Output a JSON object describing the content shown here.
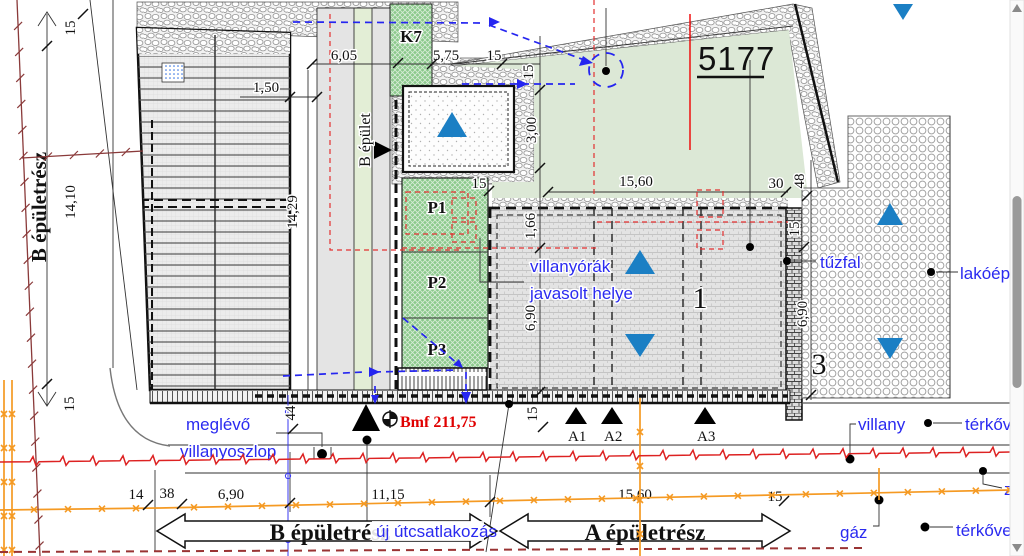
{
  "parcel_number": "5177",
  "areas": {
    "k7": "K7",
    "p1": "P1",
    "p2": "P2",
    "p3": "P3",
    "building_b_part_left": "B épületrész",
    "building_b": "B épület",
    "unit_one": "1",
    "unit_three": "3"
  },
  "labels_blue": {
    "existing_pole_line1": "meglévő",
    "existing_pole_line2": "villanyoszlop",
    "meters_line1": "villanyórák",
    "meters_line2": "javasolt helye",
    "firewall": "tűzfal",
    "residential": "lakóépü",
    "electric": "villany",
    "paving_top": "térkőve",
    "z_cut": "z",
    "gas": "gáz",
    "paving_bottom": "térkőve",
    "new_road_connection": "új útcsatlakozás"
  },
  "labels_red": {
    "benchmark": "Bmf 211,75"
  },
  "survey_points": {
    "a1": "A1",
    "a2": "A2",
    "a3": "A3"
  },
  "bottom_arrows": {
    "b": "B épületrész",
    "a": "A épületrész"
  },
  "dims": {
    "d15a": "15",
    "d1410": "14,10",
    "d15b": "15",
    "d150": "1,50",
    "d605": "6,05",
    "d575": "5,75",
    "d15c": "15",
    "d15d": "15",
    "d300": "3,00",
    "d15e": "15",
    "d166": "1,66",
    "d690a": "6,90",
    "d1429": "14,29",
    "d1560a": "15,60",
    "d30": "30",
    "d48": "48",
    "d15f": "15",
    "d690b": "6,90",
    "d44": "44",
    "d14": "14",
    "d38": "38",
    "d690c": "6,90",
    "d1115": "11,15",
    "d1560b": "15,60",
    "d15g": "15",
    "d15h": "15"
  },
  "colors": {
    "accent_blue": "#2a2af0",
    "triangle_blue": "#1b7fc4",
    "benchmark_red": "#e00000",
    "gas_orange": "#f59a23",
    "fence_darkred": "#8a3a3a",
    "electric_red": "#dd2222",
    "green_area": "#dce8d6",
    "green_hatch": "#8cc98c"
  }
}
